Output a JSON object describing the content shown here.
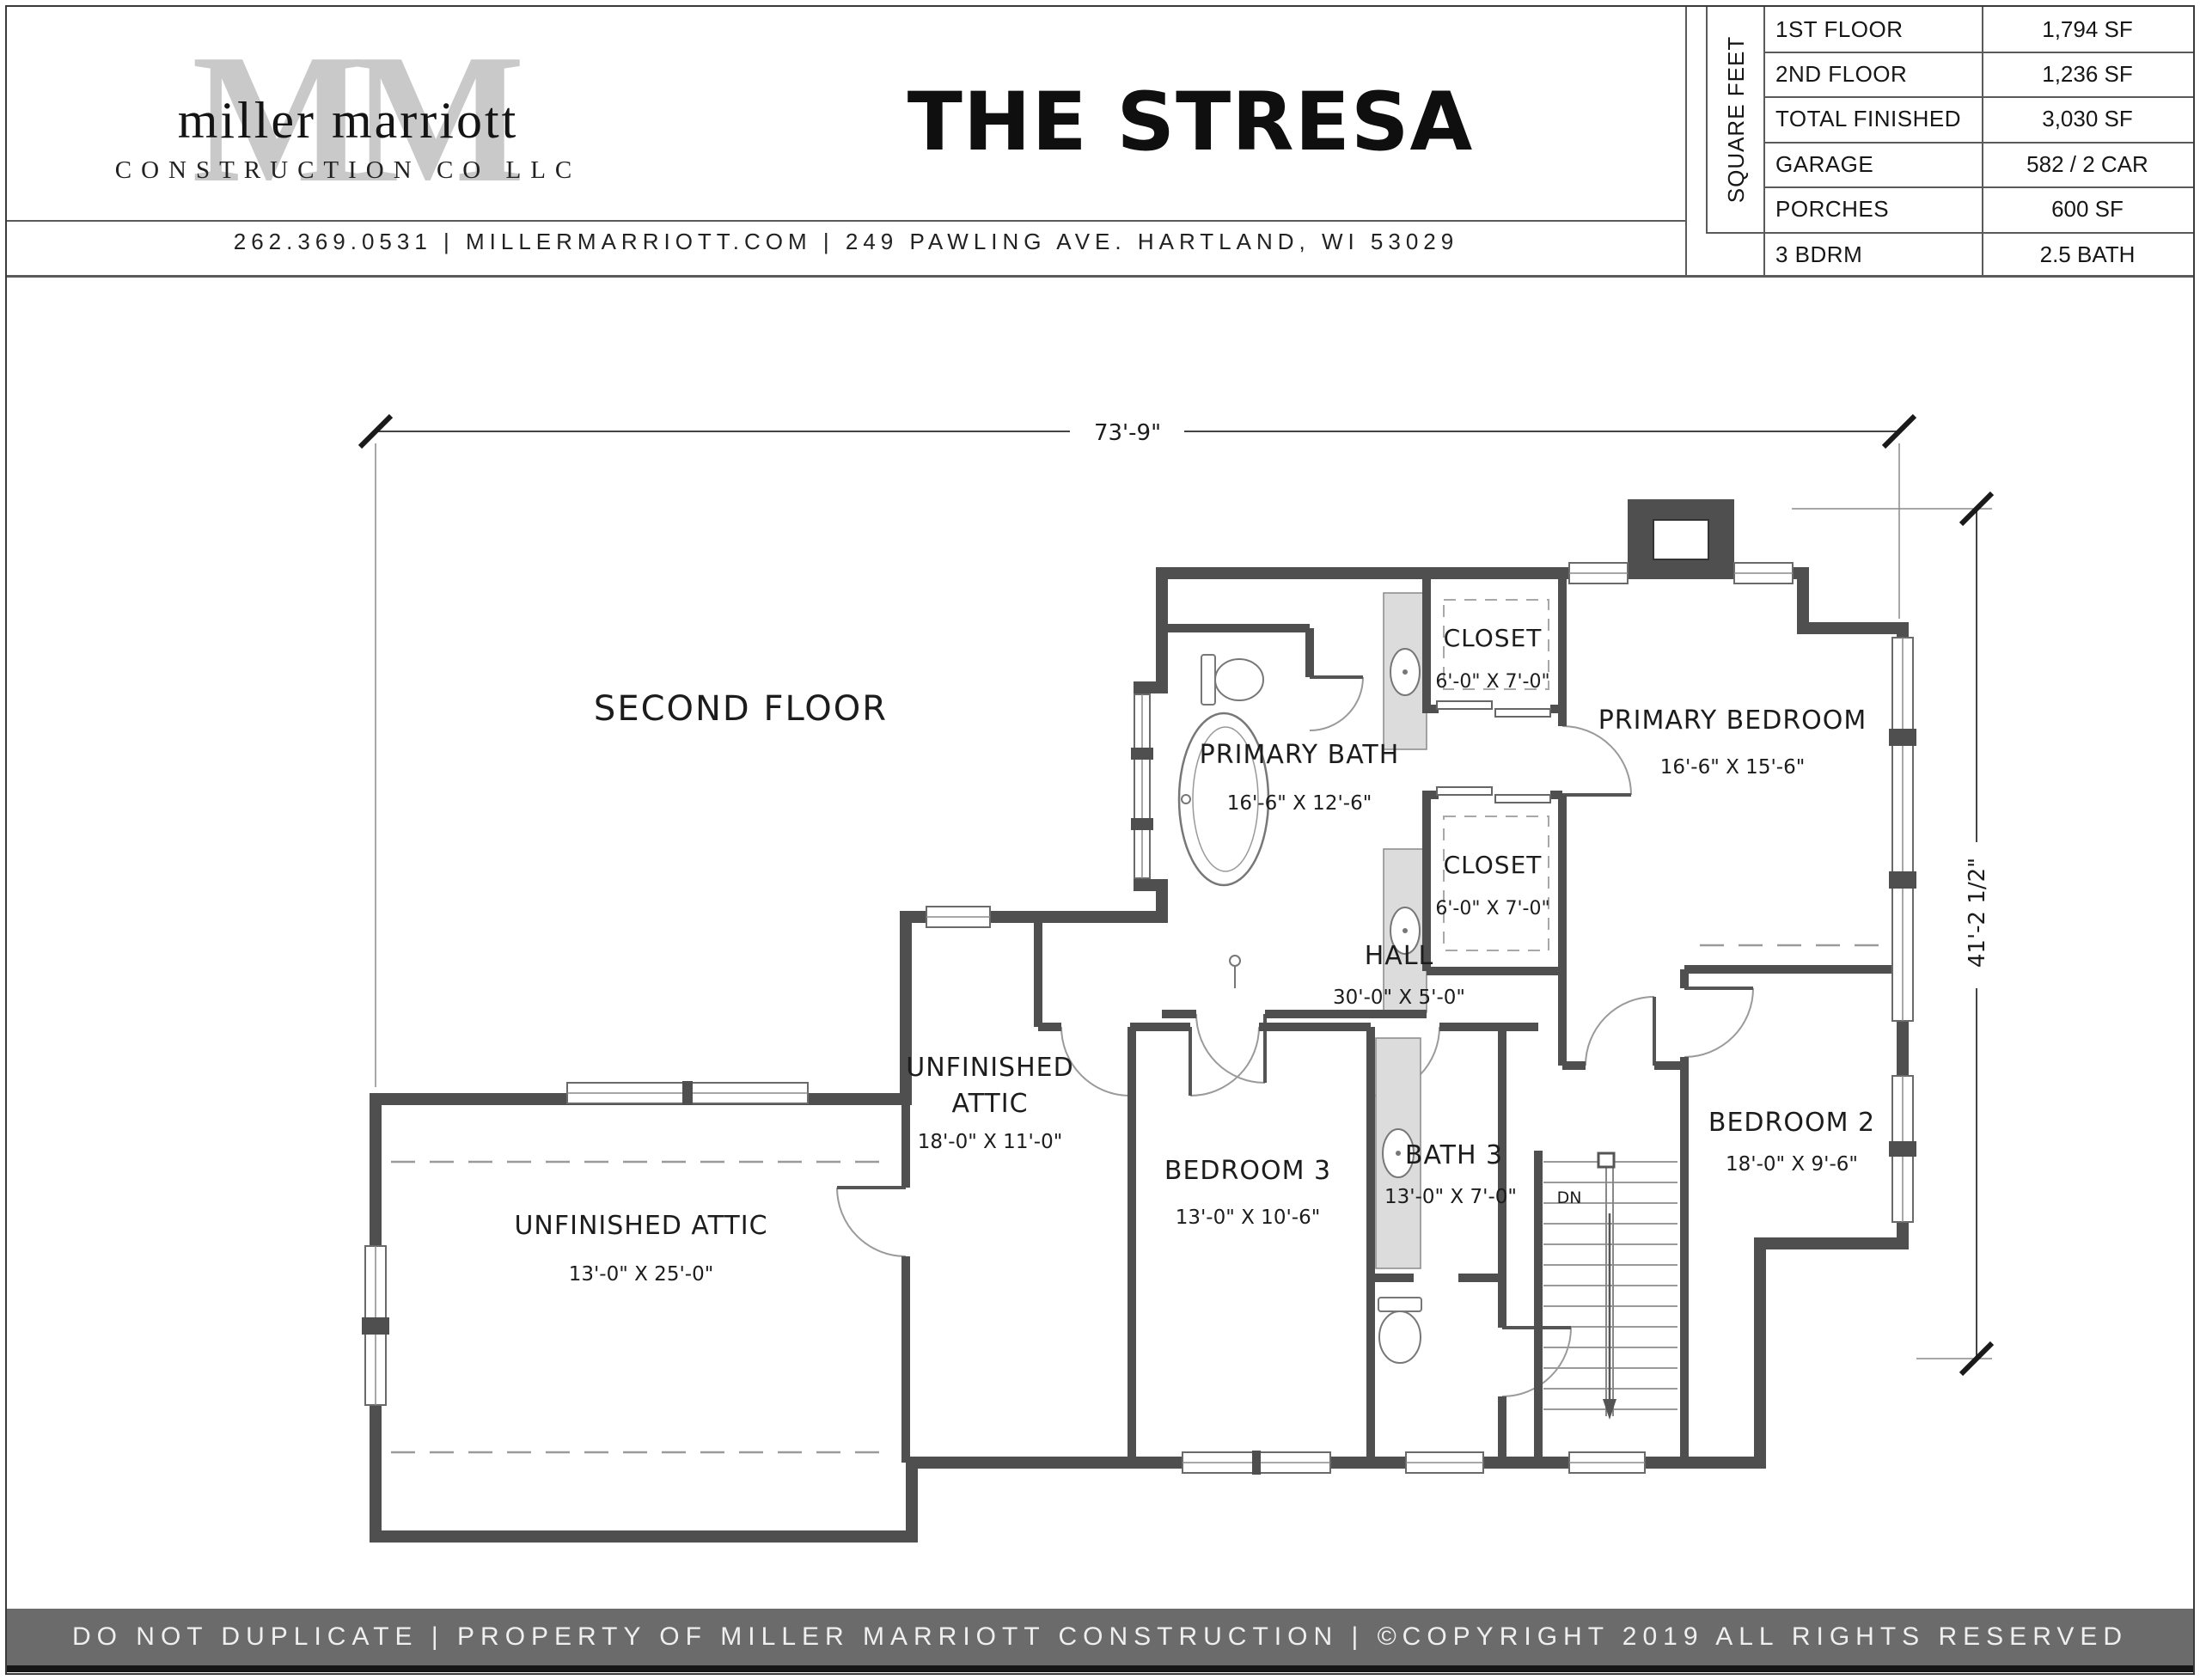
{
  "header": {
    "logo": {
      "watermark": "MM",
      "name": "miller marriott",
      "subtitle": "CONSTRUCTION CO LLC"
    },
    "title": "THE STRESA",
    "contact": "262.369.0531  |  MILLERMARRIOTT.COM   |   249 PAWLING AVE. HARTLAND, WI 53029",
    "spec_table": {
      "side_label": "SQUARE FEET",
      "rows": [
        {
          "label": "1ST FLOOR",
          "value": "1,794 SF"
        },
        {
          "label": "2ND FLOOR",
          "value": "1,236 SF"
        },
        {
          "label": "TOTAL FINISHED",
          "value": "3,030 SF"
        },
        {
          "label": "GARAGE",
          "value": "582 / 2 CAR"
        },
        {
          "label": "PORCHES",
          "value": "600 SF"
        },
        {
          "label": "3 BDRM",
          "value": "2.5 BATH"
        }
      ]
    }
  },
  "plan": {
    "floor_label": "SECOND FLOOR",
    "overall_width": "73'-9\"",
    "overall_depth": "41'-2 1/2\"",
    "stairs_label": "DN",
    "rooms": {
      "primary_bath": {
        "name": "PRIMARY BATH",
        "dims": "16'-6\" X 12'-6\""
      },
      "closet_a": {
        "name": "CLOSET",
        "dims": "6'-0\" X 7'-0\""
      },
      "closet_b": {
        "name": "CLOSET",
        "dims": "6'-0\" X 7'-0\""
      },
      "primary_bedroom": {
        "name": "PRIMARY BEDROOM",
        "dims": "16'-6\" X 15'-6\""
      },
      "hall": {
        "name": "HALL",
        "dims": "30'-0\" X 5'-0\""
      },
      "attic_small": {
        "name_line1": "UNFINISHED",
        "name_line2": "ATTIC",
        "dims": "18'-0\" X 11'-0\""
      },
      "bedroom_3": {
        "name": "BEDROOM 3",
        "dims": "13'-0\" X 10'-6\""
      },
      "bath_3": {
        "name": "BATH 3",
        "dims": "13'-0\" X 7'-0\""
      },
      "bedroom_2": {
        "name": "BEDROOM 2",
        "dims": "18'-0\" X 9'-6\""
      },
      "attic_large": {
        "name": "UNFINISHED ATTIC",
        "dims": "13'-0\" X 25'-0\""
      }
    }
  },
  "footer": {
    "text": "DO NOT DUPLICATE | PROPERTY OF MILLER MARRIOTT CONSTRUCTION | ©COPYRIGHT 2019 ALL RIGHTS RESERVED"
  }
}
